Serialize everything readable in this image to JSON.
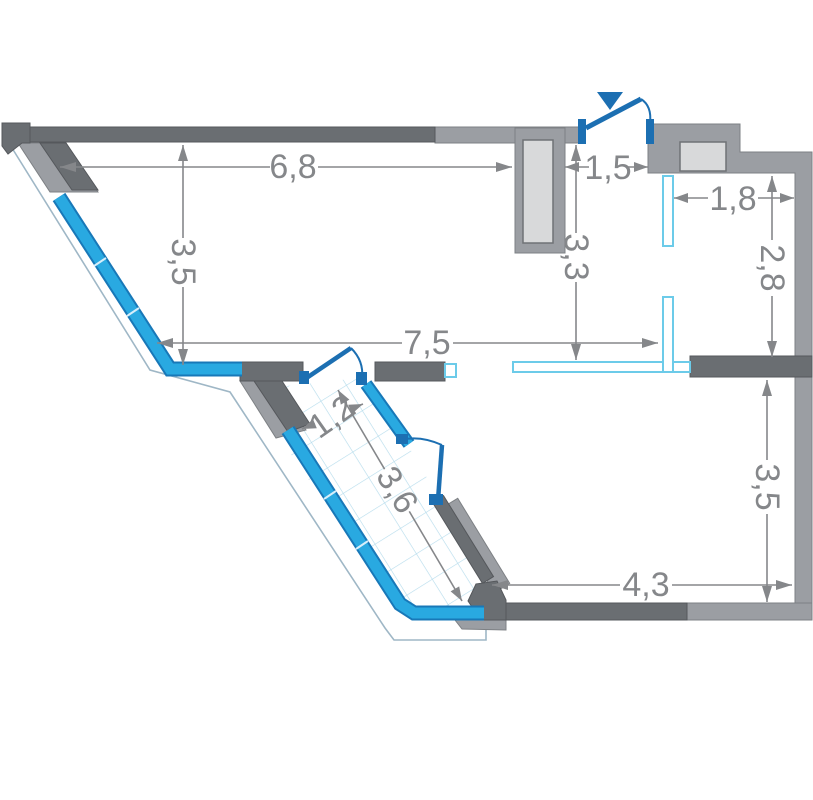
{
  "floor_plan": {
    "title": "apartment-floor-plan",
    "marker": {
      "entrance_icon": "entrance-triangle-icon"
    },
    "colors": {
      "wall_dark": "#6a6e72",
      "wall_light": "#9b9ea3",
      "shaft_fill": "#d8d9da",
      "window_blue": "#29a9e1",
      "window_outline": "#1878b8",
      "door_blue": "#1c6fb2",
      "partition_cyan": "#6ccbe9",
      "tile_grid_blue": "#b5dcec",
      "dimension_gray": "#85878a"
    },
    "dims": {
      "w68": {
        "label": "6,8",
        "orientation": "horizontal"
      },
      "w35l": {
        "label": "3,5",
        "orientation": "vertical"
      },
      "w15": {
        "label": "1,5",
        "orientation": "horizontal"
      },
      "w18": {
        "label": "1,8",
        "orientation": "horizontal"
      },
      "w33": {
        "label": "3,3",
        "orientation": "vertical"
      },
      "w28": {
        "label": "2,8",
        "orientation": "vertical"
      },
      "w75": {
        "label": "7,5",
        "orientation": "horizontal"
      },
      "w12": {
        "label": "1,2",
        "orientation": "diagonal"
      },
      "w36": {
        "label": "3,6",
        "orientation": "diagonal"
      },
      "w35r": {
        "label": "3,5",
        "orientation": "vertical"
      },
      "w43": {
        "label": "4,3",
        "orientation": "horizontal"
      }
    }
  }
}
